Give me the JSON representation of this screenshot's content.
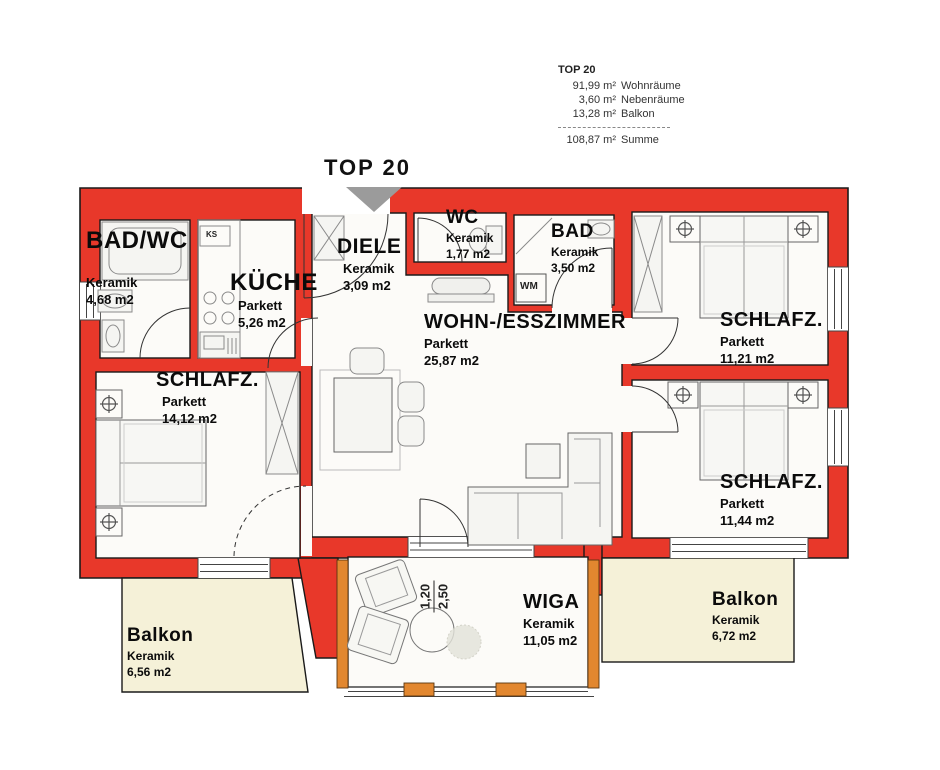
{
  "legend": {
    "title": "TOP 20",
    "items": [
      {
        "amount": "91,99 m²",
        "label": "Wohnräume"
      },
      {
        "amount": "3,60 m²",
        "label": "Nebenräume"
      },
      {
        "amount": "13,28 m²",
        "label": "Balkon"
      }
    ],
    "total": {
      "amount": "108,87 m²",
      "label": "Summe"
    }
  },
  "plan_title": "TOP 20",
  "rooms": [
    {
      "name": "BAD/WC",
      "floor": "Keramik",
      "area": "4,68 m2"
    },
    {
      "name": "KÜCHE",
      "floor": "Parkett",
      "area": "5,26 m2"
    },
    {
      "name": "DIELE",
      "floor": "Keramik",
      "area": "3,09 m2"
    },
    {
      "name": "WC",
      "floor": "Keramik",
      "area": "1,77 m2"
    },
    {
      "name": "BAD",
      "floor": "Keramik",
      "area": "3,50 m2"
    },
    {
      "name": "WOHN-/ESSZIMMER",
      "floor": "Parkett",
      "area": "25,87 m2"
    },
    {
      "name": "SCHLAFZ.",
      "floor": "Parkett",
      "area": "11,21 m2"
    },
    {
      "name": "SCHLAFZ.",
      "floor": "Parkett",
      "area": "14,12 m2"
    },
    {
      "name": "SCHLAFZ.",
      "floor": "Parkett",
      "area": "11,44 m2"
    },
    {
      "name": "WIGA",
      "floor": "Keramik",
      "area": "11,05 m2"
    },
    {
      "name": "Balkon",
      "floor": "Keramik",
      "area": "6,56 m2"
    },
    {
      "name": "Balkon",
      "floor": "Keramik",
      "area": "6,72 m2"
    }
  ],
  "small_labels": {
    "fridge": "KS",
    "washer": "WM"
  },
  "dimension": {
    "width": "1,20",
    "depth": "2,50"
  },
  "colors": {
    "wall_red": "#e8382a",
    "balcony_cream": "#f5f1d8",
    "frame_orange": "#e2872f",
    "arrow_gray": "#9b9b9b"
  }
}
